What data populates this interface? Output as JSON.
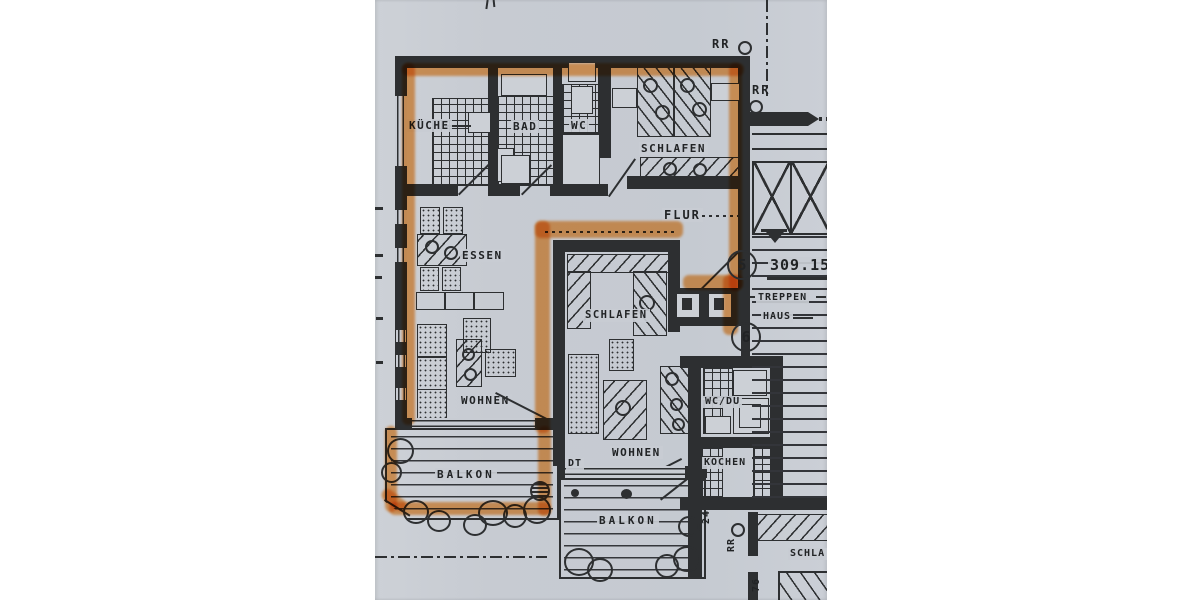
{
  "rooms": {
    "kueche": "KÜCHE",
    "bad": "BAD",
    "wc": "WC",
    "schlafen_top": "SCHLAFEN",
    "flur": "FLUR",
    "essen": "ESSEN",
    "wohnen": "WOHNEN",
    "schlafen_mid": "SCHLAFEN",
    "wohnen2": "WOHNEN",
    "balkon1": "BALKON",
    "balkon2": "BALKON",
    "kochen": "KOCHEN",
    "wcdu": "WC/DU",
    "treppen_1": "TREPPEN",
    "treppen_2": "HAUS",
    "schlafen_cut": "SCHLA"
  },
  "annotations": {
    "level": "309.15",
    "unit_top": "5",
    "unit_bottom": "6",
    "rr_top": "RR",
    "rr_right": "RR",
    "rr_bottom": "RR",
    "downpipe": "DT",
    "dim_24": "24",
    "dim_76": "76"
  },
  "colors": {
    "paper": "#c8ccd3",
    "ink": "#2d2f31",
    "highlight": "#f79d49"
  }
}
